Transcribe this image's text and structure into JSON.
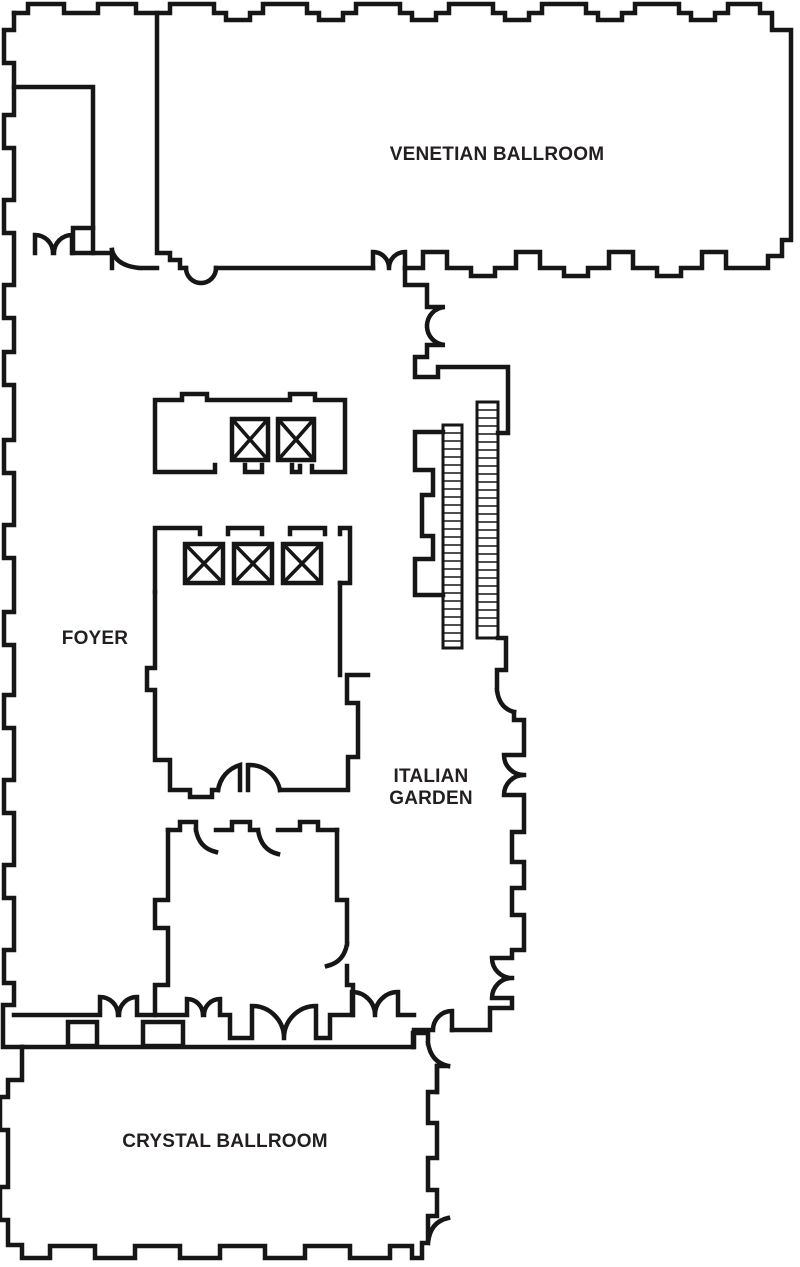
{
  "colors": {
    "wall": "#161616",
    "label": "#231f20",
    "background": "#ffffff"
  },
  "rooms": [
    {
      "id": "venetian-ballroom",
      "label": "VENETIAN BALLROOM"
    },
    {
      "id": "foyer",
      "label": "FOYER"
    },
    {
      "id": "italian-garden",
      "label": "ITALIAN GARDEN",
      "lines": [
        "ITALIAN",
        "GARDEN"
      ]
    },
    {
      "id": "crystal-ballroom",
      "label": "CRYSTAL BALLROOM"
    }
  ],
  "features": {
    "elevator_banks": [
      {
        "shafts": 2
      },
      {
        "shafts": 3
      }
    ],
    "stair_flights": 2
  }
}
